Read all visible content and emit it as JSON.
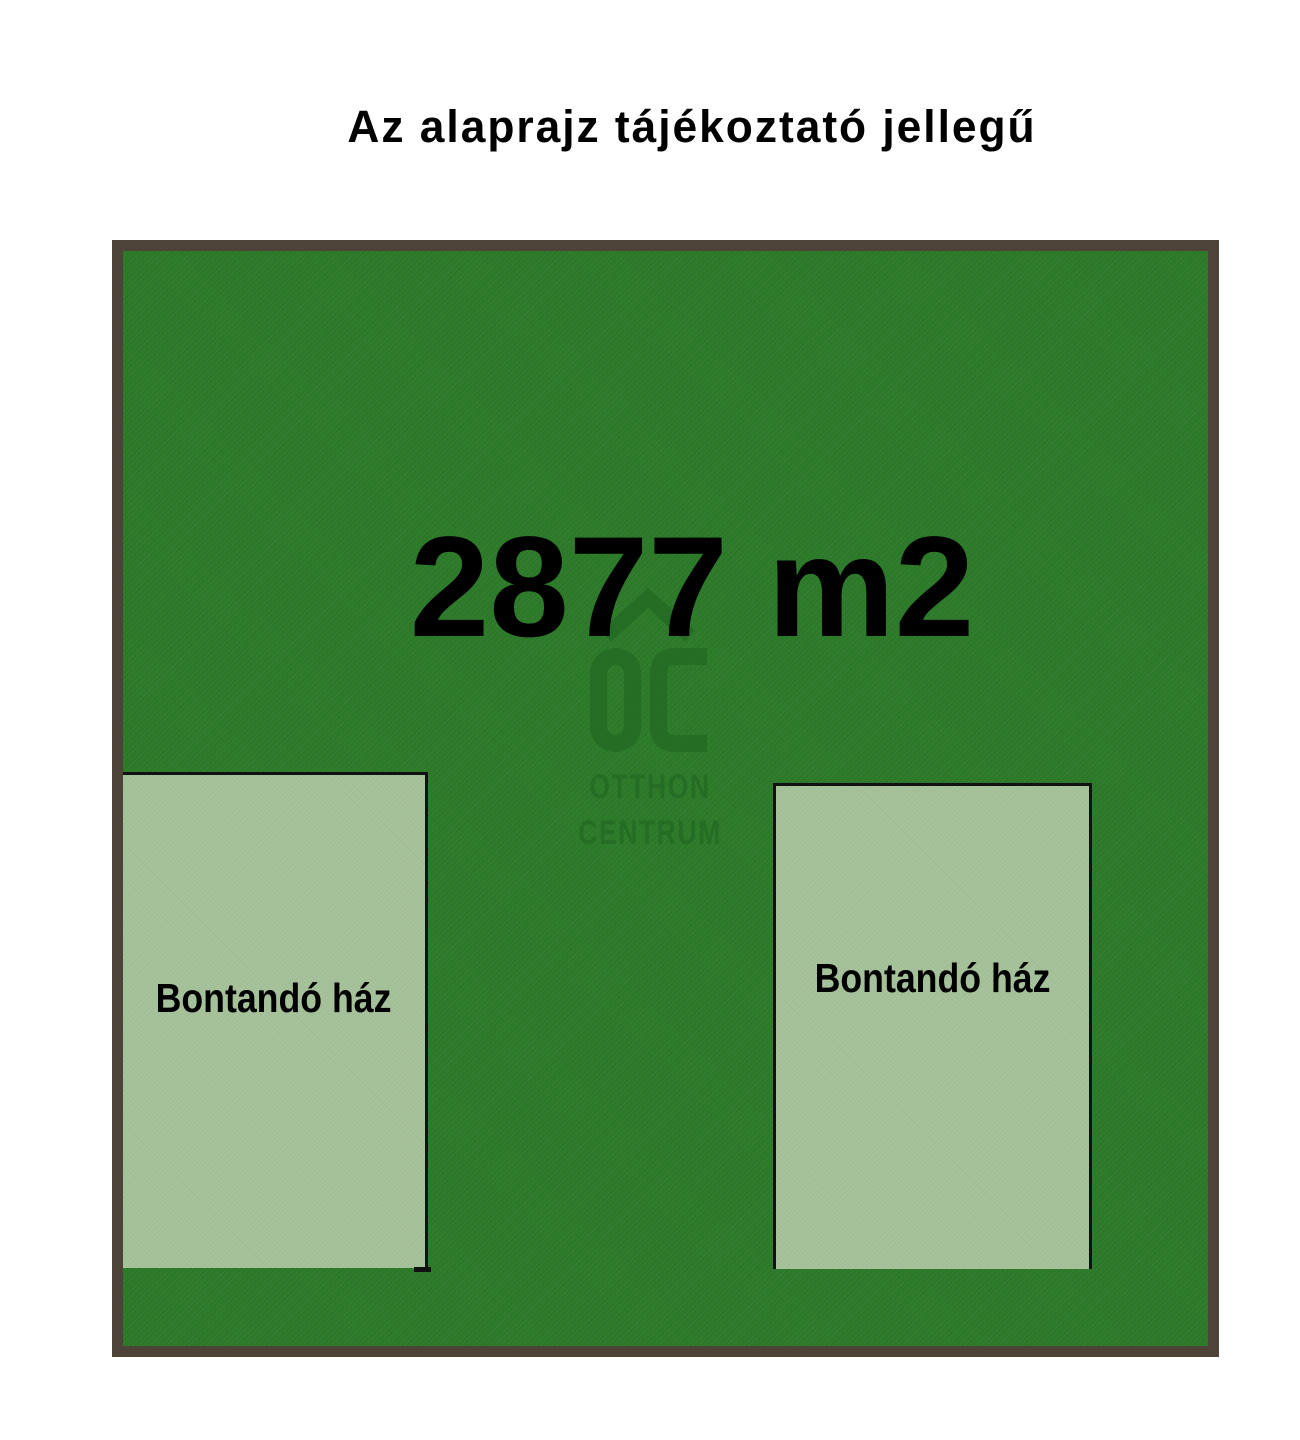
{
  "page": {
    "title": "Az alaprajz tájékoztató jellegű"
  },
  "plot": {
    "area_label": "2877 m2",
    "houses": [
      {
        "label": "Bontandó ház"
      },
      {
        "label": "Bontandó ház"
      }
    ]
  },
  "watermark": {
    "monogram": "OC",
    "line1": "OTTHON",
    "line2": "CENTRUM"
  },
  "colors": {
    "background": "#ffffff",
    "text": "#000000",
    "plot_fill": "#2d7d2a",
    "plot_border": "#4d4339",
    "house_fill": "#a5c29a",
    "house_border": "#111111",
    "watermark": "#256c24"
  }
}
